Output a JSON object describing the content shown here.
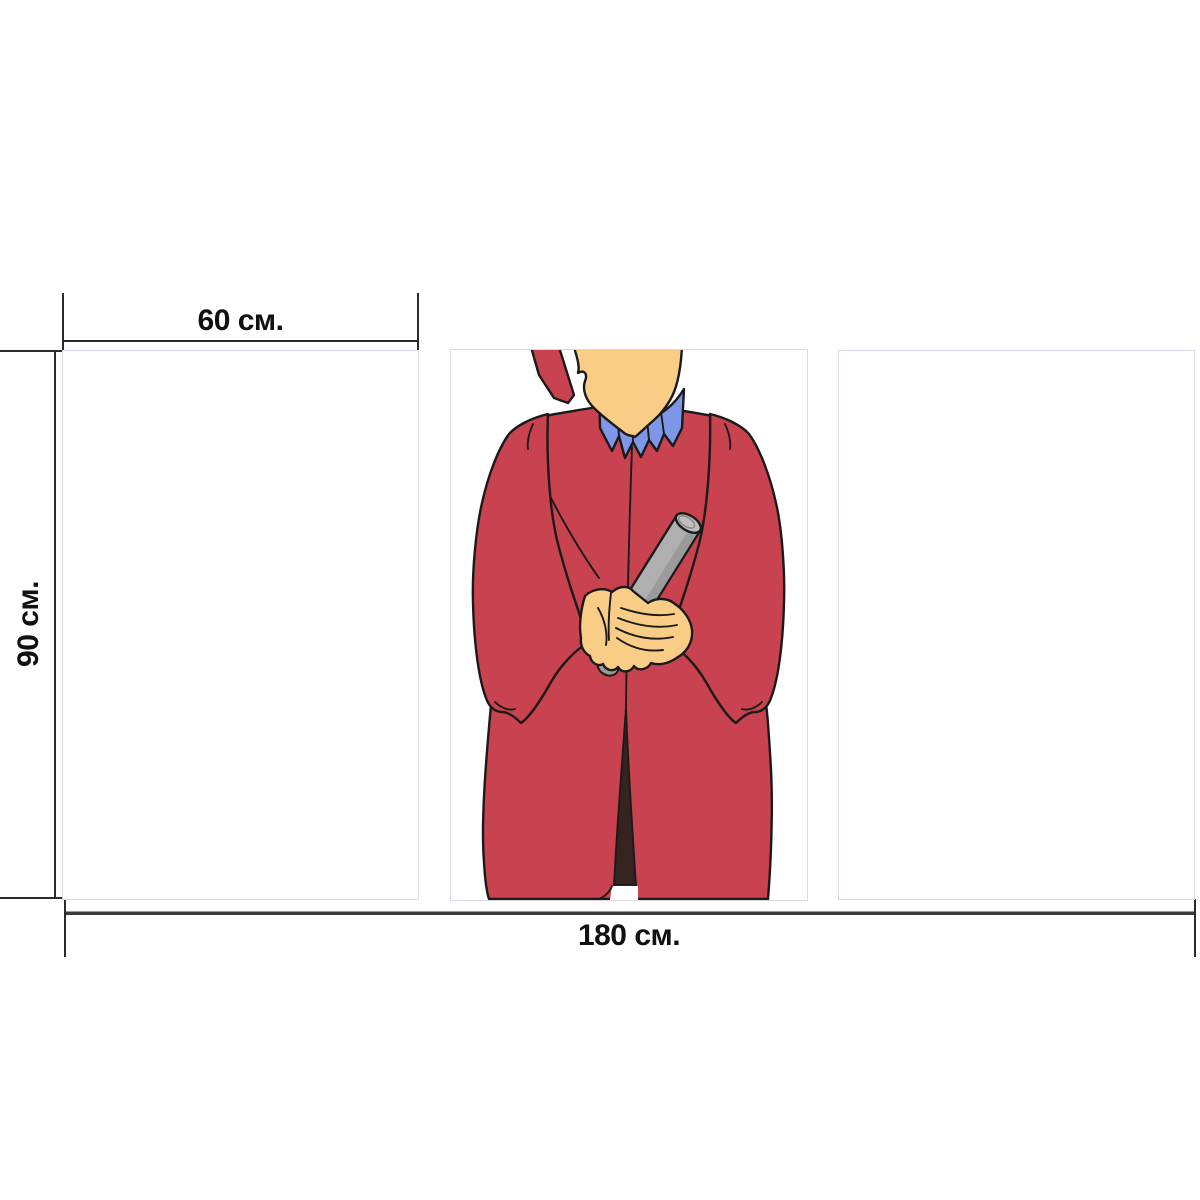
{
  "mockup": {
    "dimension_labels": {
      "panel_width": "60 см.",
      "panel_height": "90 см.",
      "total_width": "180 см."
    },
    "panels": [
      {
        "id": "left",
        "illustration": ""
      },
      {
        "id": "center",
        "illustration": "graduate-in-red-gown-holding-diploma"
      },
      {
        "id": "right",
        "illustration": ""
      }
    ],
    "colors": {
      "gown": "#C9424F",
      "skin": "#F9CD85",
      "collar": "#7E97E8",
      "diploma": "#AFAFAF",
      "diploma_shade": "#9B9B9B",
      "diploma_end": "#BEBEBE",
      "gown_lining": "#35231F",
      "outline": "#1A1A1A",
      "dimension_line": "#2B2B2B",
      "dimension_line_bottom": "#3A3A3A",
      "label_text": "#111111",
      "panel_border": "#DBD7E4"
    }
  }
}
